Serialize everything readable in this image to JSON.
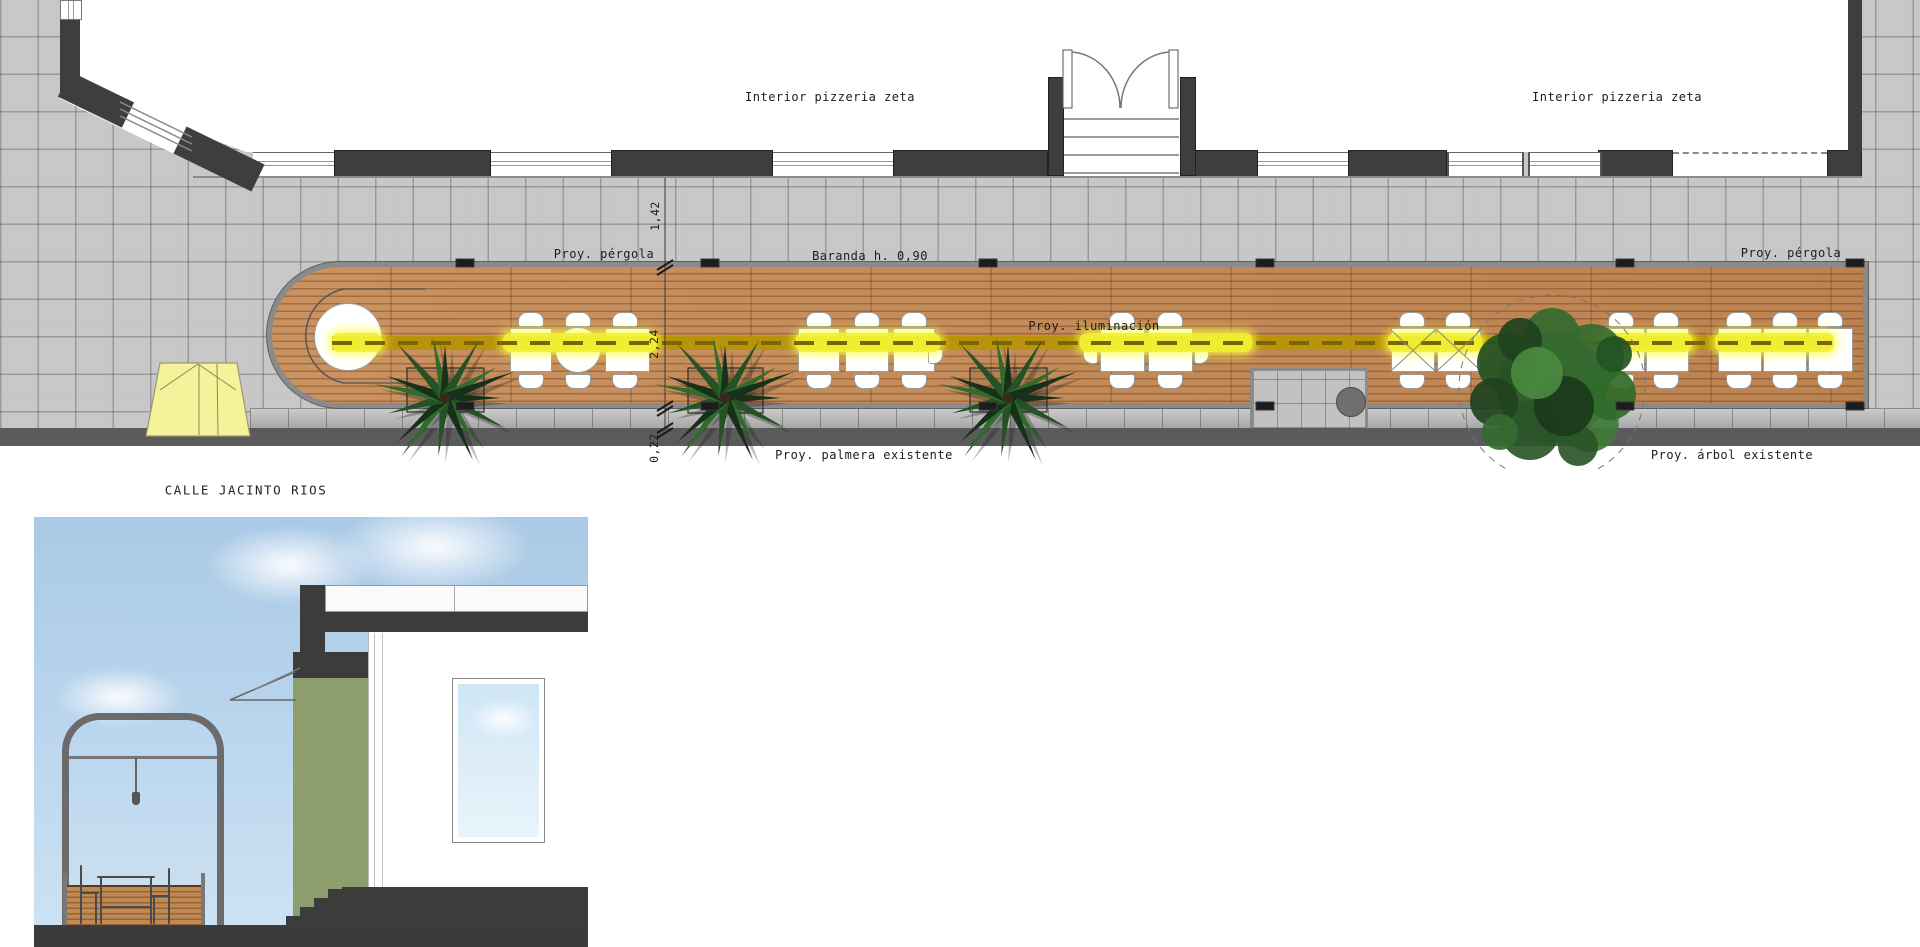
{
  "title": "Terraza pizzeria zeta - planta y seccion",
  "plan": {
    "labels": {
      "interior_left": "Interior pizzeria zeta",
      "interior_right": "Interior pizzeria zeta",
      "pergola_left": "Proy. pérgola",
      "pergola_right": "Proy. pérgola",
      "baranda": "Baranda h. 0,90",
      "iluminacion": "Proy. iluminación",
      "palmera": "Proy. palmera existente",
      "arbol": "Proy. árbol existente",
      "calle": "CALLE JACINTO RIOS"
    },
    "dimensions": {
      "wall_to_deck": "1,42",
      "deck_width": "2,24",
      "deck_to_road": "0,22"
    },
    "colors": {
      "paving": "#c7c7c7",
      "wall": "#3e3e3e",
      "deck_wood": "#c68a55",
      "deck_rim": "#8b8b8b",
      "light_bright": "#f2f232",
      "light_base": "#b8940c",
      "road": "#5b5b5b",
      "tent": "#f6f19b",
      "palm_green": "#1c3b1c",
      "tree_green": "#2d5a2d"
    },
    "facade": {
      "dark_segments": [
        [
          334,
          491
        ],
        [
          611,
          773
        ],
        [
          893,
          1048
        ],
        [
          1195,
          1258
        ],
        [
          1348,
          1447
        ],
        [
          1598,
          1673
        ],
        [
          1827,
          1862
        ]
      ],
      "windows": [
        [
          253,
          334
        ],
        [
          491,
          611
        ],
        [
          773,
          893
        ],
        [
          1258,
          1348
        ]
      ],
      "windows_mullioned": [
        [
          1447,
          1520
        ],
        [
          1528,
          1598
        ]
      ],
      "opening_dashed": [
        1673,
        1827
      ]
    },
    "pergola_posts_x": [
      465,
      710,
      988,
      1265,
      1625,
      1855
    ],
    "light_bright_segments": [
      [
        332,
        382
      ],
      [
        503,
        657
      ],
      [
        796,
        940
      ],
      [
        1080,
        1252
      ],
      [
        1388,
        1482
      ],
      [
        1598,
        1692
      ],
      [
        1715,
        1834
      ]
    ],
    "tables_square": [
      {
        "x": 510,
        "w": 42
      },
      {
        "x": 605,
        "w": 45
      },
      {
        "x": 798,
        "w": 42
      },
      {
        "x": 845,
        "w": 44
      },
      {
        "x": 893,
        "w": 42
      },
      {
        "x": 1100,
        "w": 45
      },
      {
        "x": 1148,
        "w": 45
      },
      {
        "x": 1391,
        "w": 44,
        "x_mark": true
      },
      {
        "x": 1437,
        "w": 44,
        "x_mark": true
      },
      {
        "x": 1602,
        "w": 43
      },
      {
        "x": 1646,
        "w": 43
      },
      {
        "x": 1718,
        "w": 44
      },
      {
        "x": 1763,
        "w": 44
      },
      {
        "x": 1808,
        "w": 45
      }
    ],
    "tables_round": [
      {
        "cx": 578,
        "cy": 350,
        "r": 23
      }
    ],
    "end_round_table": {
      "cx": 347,
      "cy": 336,
      "r": 33
    },
    "chairs_top_cx": [
      531,
      578,
      625,
      819,
      867,
      914,
      1122,
      1170,
      1412,
      1458,
      1621,
      1666,
      1739,
      1785,
      1830
    ],
    "chairs_bottom_cx": [
      531,
      578,
      625,
      819,
      867,
      914,
      1122,
      1170,
      1412,
      1458,
      1621,
      1666,
      1739,
      1785,
      1830
    ],
    "side_chairs": [
      {
        "x": 928,
        "side": "right"
      },
      {
        "x": 1083,
        "side": "left"
      },
      {
        "x": 1194,
        "side": "right"
      }
    ],
    "palms": [
      {
        "cx": 445,
        "cy": 398
      },
      {
        "cx": 725,
        "cy": 398
      },
      {
        "cx": 1008,
        "cy": 398
      }
    ],
    "planters": [
      [
        407,
        368,
        77,
        44
      ],
      [
        688,
        368,
        75,
        45
      ],
      [
        970,
        368,
        77,
        44
      ],
      [
        1507,
        350,
        86,
        60
      ]
    ],
    "tree": {
      "cx": 1552,
      "cy": 388,
      "r_dashed": 93
    },
    "notch_circle": {
      "cx": 1350,
      "cy": 401,
      "r": 14
    }
  },
  "section": {
    "colors": {
      "sky": "#bcd7ee",
      "green_wall": "#8e9d6c",
      "structure_dark": "#3c3c3c",
      "pergola_frame": "#6b6b6b",
      "deck_wood": "#c08a55"
    }
  }
}
